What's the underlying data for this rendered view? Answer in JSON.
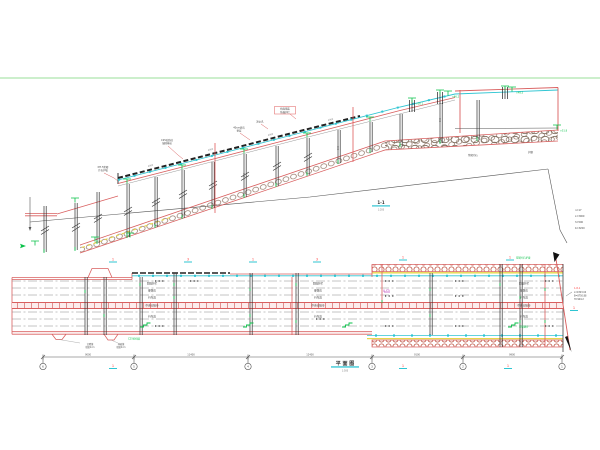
{
  "colors": {
    "line_red": "#d95f5f",
    "axis_red": "#ff4040",
    "cyan": "#2fc5d2",
    "green": "#0ac24a",
    "pale_green": "#9adf9a",
    "yellow": "#e6d84a",
    "magenta": "#c050c0",
    "dark": "#333333",
    "gray": "#777777"
  },
  "elevation": {
    "callouts": [
      [
        "M7.5浆砌",
        "片石护坡"
      ],
      [
        "C25砼肋柱",
        "锚固基岩"
      ],
      [
        "40cm碎石",
        "垫层"
      ],
      [
        "泄水孔",
        ""
      ],
      [
        "桥面铺装",
        "防撞护栏"
      ]
    ],
    "levels": [
      "▽46.2",
      "▽48.5",
      "▽50.1",
      "▽51.8"
    ],
    "riprap1": "浆砌片石",
    "riprap2": "护脚",
    "note": [
      "n=17",
      "L=3000",
      "h=500",
      "b=3200"
    ],
    "dim_deck": "4000",
    "dim_pier": "500",
    "section_label": "1-1",
    "section_scale": "1:200"
  },
  "plan": {
    "title": "平 面 图",
    "title_scale": "1:500",
    "rows": [
      "防撞护栏",
      "硬路肩",
      "行车道",
      "中央分隔带",
      "行车道"
    ],
    "joints": [
      [
        "沉降缝",
        "缝宽2cm"
      ],
      [
        "伸缩缝",
        "缝宽4cm"
      ]
    ],
    "green_left": "C25砼挡墙",
    "green_top": "浆砌片石护坡",
    "stairs_label": "浆砌踏步",
    "slope": "2%",
    "axis_top": [
      "1",
      "3",
      "1",
      "3",
      "1",
      "1"
    ],
    "bubbles": [
      "6",
      "5",
      "4",
      "3",
      "2",
      "1"
    ],
    "dims": [
      "9000",
      "11400",
      "12400",
      "9100",
      "9900"
    ],
    "note": [
      "1-8-1",
      "L=9323.04",
      "B=8750.88",
      "H=904.2"
    ],
    "sec": "1"
  }
}
